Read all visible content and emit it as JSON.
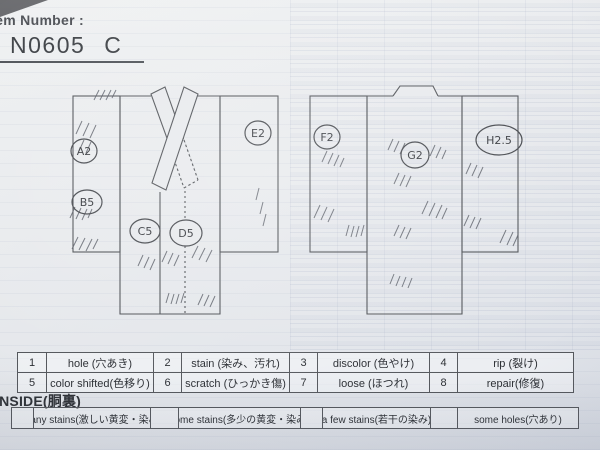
{
  "header": {
    "item_number_label": "Item Number :",
    "item_number": "N0605",
    "item_suffix": "C"
  },
  "diagram": {
    "front_defects": [
      {
        "label": "A2"
      },
      {
        "label": "B5"
      },
      {
        "label": "C5"
      },
      {
        "label": "D5"
      },
      {
        "label": "E2"
      }
    ],
    "back_defects": [
      {
        "label": "F2"
      },
      {
        "label": "G2"
      },
      {
        "label": "H2.5"
      }
    ]
  },
  "legend": {
    "rows": [
      [
        {
          "num": "1",
          "label": "hole (穴あき)"
        },
        {
          "num": "2",
          "label": "stain (染み、汚れ)"
        },
        {
          "num": "3",
          "label": "discolor (色やけ)"
        },
        {
          "num": "4",
          "label": "rip (裂け)"
        }
      ],
      [
        {
          "num": "5",
          "label": "color shifted(色移り)"
        },
        {
          "num": "6",
          "label": "scratch (ひっかき傷)"
        },
        {
          "num": "7",
          "label": "loose (ほつれ)"
        },
        {
          "num": "8",
          "label": "repair(修復)"
        }
      ]
    ]
  },
  "inside": {
    "title": "INSIDE(胴裏)",
    "options": [
      {
        "label": "many stains(激しい黄変・染み)"
      },
      {
        "label": "some stains(多少の黄変・染み)"
      },
      {
        "label": "a few stains(若干の染み)"
      },
      {
        "label": "some holes(穴あり)"
      }
    ]
  },
  "colors": {
    "paper": "#e8eaed",
    "ink": "#4e5156"
  }
}
